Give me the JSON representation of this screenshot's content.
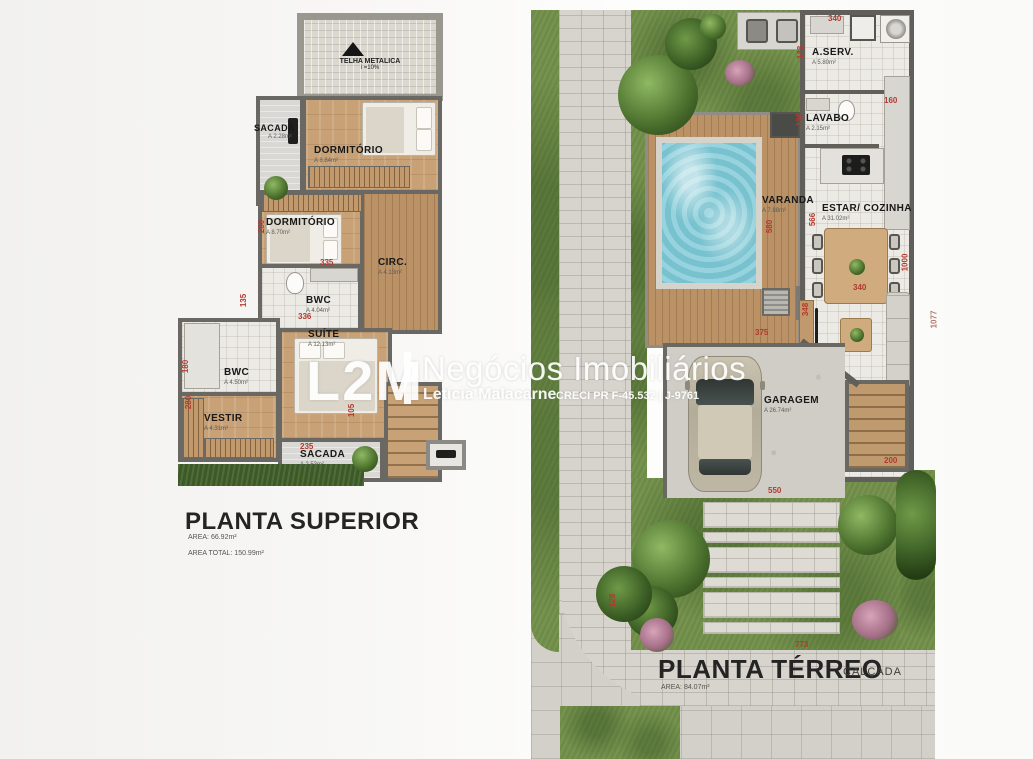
{
  "watermark": {
    "logo": "L2M",
    "brand": "Negócios Imobiliários",
    "agent": "Letícia Malacarne",
    "creci": "CRECI PR F-45.532 | J-9761"
  },
  "upper_plan": {
    "title": "PLANTA SUPERIOR",
    "area": "AREA: 66.92m²",
    "area_total": "AREA TOTAL: 150.99m²",
    "roof": {
      "label": "TELHA METALICA",
      "slope": "i =10%"
    },
    "rooms": [
      {
        "name": "SACADA",
        "area": "A 2.28m²"
      },
      {
        "name": "DORMITÓRIO",
        "area": "A 8.84m²"
      },
      {
        "name": "DORMITÓRIO",
        "area": "A 8.70m²"
      },
      {
        "name": "CIRC.",
        "area": "A 4.13m²"
      },
      {
        "name": "BWC",
        "area": "A 4.04m²"
      },
      {
        "name": "SUÍTE",
        "area": "A 12.13m²"
      },
      {
        "name": "BWC",
        "area": "A 4.50m²"
      },
      {
        "name": "VESTIR",
        "area": "A 4.31m²"
      },
      {
        "name": "SACADA",
        "area": "A 2.53m²"
      }
    ],
    "dimensions": [
      "280",
      "335",
      "135",
      "336",
      "180",
      "280",
      "105",
      "235"
    ]
  },
  "ground_plan": {
    "title": "PLANTA TÉRREO",
    "area": "AREA: 84.07m²",
    "sidewalk_label": "CALÇADA",
    "rooms": [
      {
        "name": "A.SERV.",
        "area": "A 5.80m²"
      },
      {
        "name": "LAVABO",
        "area": "A 2.15m²"
      },
      {
        "name": "VARANDA",
        "area": "A 7.88m²"
      },
      {
        "name": "ESTAR/ COZINHA",
        "area": "A 31.02m²"
      },
      {
        "name": "GARAGEM",
        "area": "A 26.74m²"
      }
    ],
    "dimensions": [
      "340",
      "148",
      "130",
      "160",
      "580",
      "566",
      "1000",
      "340",
      "375",
      "1077",
      "348",
      "200",
      "550",
      "773",
      "128"
    ]
  },
  "colors": {
    "dimension_red": "#b23a2e",
    "wall_gray": "#615f59",
    "wood": "#c8a276",
    "grass": "#6e8c46",
    "pool_water": "#85ccd8",
    "watermark_white": "#ffffff"
  }
}
